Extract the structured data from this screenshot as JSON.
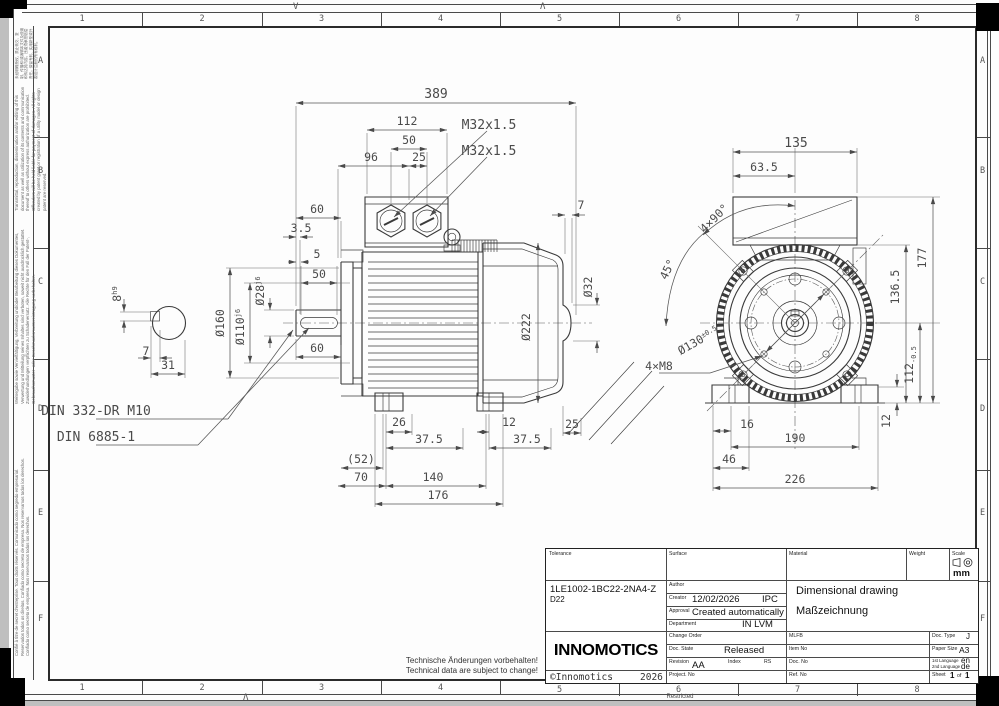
{
  "sheet": {
    "grid_columns": [
      "1",
      "2",
      "3",
      "4",
      "5",
      "6",
      "7",
      "8"
    ],
    "grid_rows": [
      "A",
      "B",
      "C",
      "D",
      "E",
      "F"
    ],
    "fold_mark_top_left": "V",
    "fold_mark_top_right": "Λ",
    "fold_mark_bottom": "Λ",
    "restricted_label": "Restricted"
  },
  "margin_notes": {
    "cjk": "未经明确授权，禁止转交、复制、传播和/或编辑本文件及使用和传达其内容。违者须承担赔偿责任。保留专利、实用新型或外观设计注册的所有权利。",
    "english": "Transmittal, reproduction, dissemination and/or editing of this document as well as utilization of its contents and communication thereof to others without express authorization are prohibited. Offenders will be held liable for payment of damages. All rights created by patent grant or registration of a utility model or design patent are reserved.",
    "german": "Weitergabe sowie Vervielfältigung, Verbreitung und/oder Bearbeitung dieses Dokumentes, Verwertung und Mitteilung seines Inhaltes sind verboten, soweit nicht ausdrücklich gestattet. Zuwiderhandlungen verpflichten zu Schadenersatz. Alle Rechte für den Fall der Patent-, Gebrauchsmuster- oder Geschmacksmustereintragung vorbehalten.",
    "romance": "Confié à titre de secret d'entreprise. Tous droits réservés. Comunicado como segredo empresarial. Reservados todos os direitos. Confiado como secreto de empresa. Nos reservamos todos los derechos. Confiado como secreto de empresa. Nos reservamos todos los derechos."
  },
  "shaft_section": {
    "key_width": "8",
    "key_width_tol": "h9",
    "key_depth": "7",
    "section_width": "31"
  },
  "side_view": {
    "top": {
      "total_length": "389",
      "box_width": "112",
      "gland_spacing": "50",
      "box_center_from_flange": "96",
      "gland_offset": "25",
      "gland1": "M32x1.5",
      "gland2": "M32x1.5"
    },
    "left": {
      "shaft_length": "60",
      "shoulder": "3.5",
      "key_start": "5",
      "key_length": "50",
      "shaft_length_b": "60",
      "flange_dia": "Ø160",
      "spigot_dia": "Ø110",
      "spigot_tol": "j6",
      "shaft_dia": "Ø28",
      "shaft_tol": "j6"
    },
    "right": {
      "stub": "7",
      "stub_dia": "Ø32",
      "frame_dia": "Ø222",
      "foot_offset": "25"
    },
    "bottom": {
      "bolt_offset": "26",
      "pitch_a": "37.5",
      "rear_offset": "12",
      "pitch_b": "37.5",
      "overhang": "(52)",
      "front_pitch": "70",
      "foot_pitch": "140",
      "foot_span": "176"
    },
    "callouts": {
      "center_hole": "DIN 332-DR M10",
      "key_standard": "DIN 6885-1"
    }
  },
  "end_view": {
    "top": {
      "box_width": "135",
      "box_half": "63.5"
    },
    "angles": {
      "pattern": "4×90°",
      "offset": "45°"
    },
    "callouts": {
      "bolt_circle": "Ø130",
      "bolt_circle_tol": "±0.5",
      "tapped_holes": "4×M8"
    },
    "right": {
      "total_height": "177",
      "box_height": "136.5",
      "shaft_height": "112",
      "shaft_height_tol": "-0.5",
      "foot_height": "12"
    },
    "bottom": {
      "bolt_edge": "16",
      "foot_pitch": "190",
      "foot_width": "46",
      "base_width": "226"
    }
  },
  "footer": {
    "note_de": "Technische Änderungen vorbehalten!",
    "note_en": "Technical data are subject to change!"
  },
  "title_block": {
    "labels": {
      "tolerance": "Tolerance",
      "surface": "Surface",
      "material": "Material",
      "weight": "Weight",
      "scale": "Scale",
      "author": "Author",
      "creator": "Creator",
      "approval": "Approval",
      "department": "Department",
      "change_order": "Change Order",
      "doc_state": "Doc. State",
      "revision": "Revision",
      "index": "Index",
      "project_no": "Project. No",
      "mlfb": "MLFB",
      "item_no": "Item No",
      "doc_no": "Doc. No",
      "ref_no": "Ref. No",
      "doc_type": "Doc. Type",
      "paper_size": "Paper Size",
      "lang1": "1st Language",
      "lang2": "2nd Language",
      "sheet": "Sheet",
      "sheet_of": "of"
    },
    "values": {
      "part_number": "1LE1002-1BC22-2NA4-Z",
      "part_suffix": "D22",
      "creator_date": "12/02/2026",
      "creator_org": "IPC",
      "approval": "Created automatically",
      "department": "IN LVM",
      "title_en": "Dimensional drawing",
      "title_de": "Maßzeichnung",
      "doc_state": "Released",
      "revision": "AA",
      "index_value": "RS",
      "doc_type": "J",
      "paper_size": "A3",
      "lang1": "en",
      "lang2": "de",
      "sheet_no": "1",
      "sheet_total": "1",
      "scale_unit": "mm"
    },
    "brand": {
      "logo": "INNOMOTICS",
      "copyright": "©Innomotics",
      "year": "2026"
    }
  }
}
